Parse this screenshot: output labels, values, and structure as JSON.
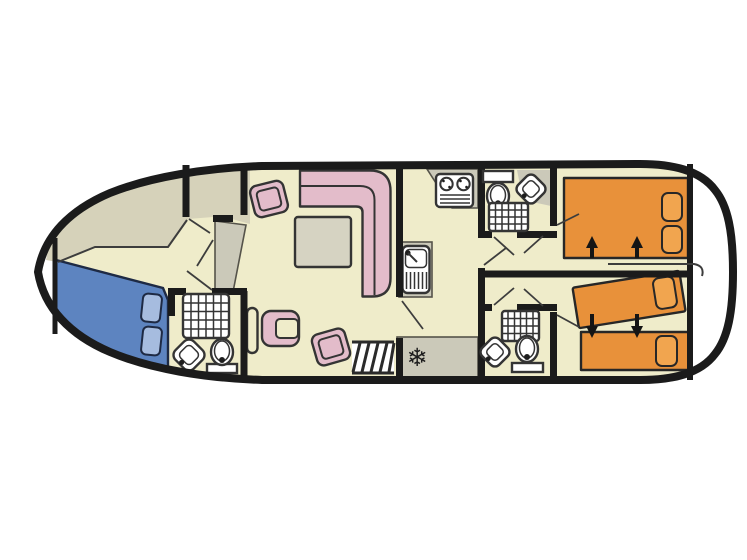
{
  "figure": {
    "kind": "boat-floorplan",
    "orientation": "bow-left",
    "visible_text": "none"
  },
  "colors": {
    "page_bg": "#ffffff",
    "wall": "#1b1b1b",
    "outline": "#343434",
    "floor": "#efecca",
    "deck": "#d6d2ba",
    "counter": "#cbc9b9",
    "table": "#d6d3c2",
    "pink": "#e3bcca",
    "blue_bed": "#5d84c0",
    "blue_pillow": "#a6bcdf",
    "orange": "#e8913a",
    "orange_pillow": "#f1a54f"
  },
  "icons": {
    "snowflake": "❄"
  },
  "rooms": [
    {
      "id": "bow-deck",
      "name": "bow deck walkway",
      "furniture": []
    },
    {
      "id": "bow-cabin",
      "name": "bow cabin",
      "furniture": [
        "blue double bed",
        "two pillows",
        "wardrobe"
      ]
    },
    {
      "id": "bow-bathroom",
      "name": "forward bathroom",
      "furniture": [
        "shower",
        "corner washbasin",
        "toilet"
      ]
    },
    {
      "id": "saloon",
      "name": "saloon and helm",
      "furniture": [
        "L-shaped sofa",
        "table",
        "chair",
        "chair",
        "helm seat",
        "steering wheel",
        "stairs"
      ]
    },
    {
      "id": "galley",
      "name": "galley",
      "furniture": [
        "two-burner hob",
        "sink",
        "worktop",
        "fridge-freezer"
      ]
    },
    {
      "id": "mid-bathroom-top",
      "name": "middle bathroom top",
      "furniture": [
        "toilet with cistern",
        "corner washbasin",
        "shower"
      ]
    },
    {
      "id": "corridor",
      "name": "central corridor",
      "furniture": []
    },
    {
      "id": "mid-bathroom-bottom",
      "name": "middle bathroom bottom",
      "furniture": [
        "shower",
        "corner washbasin",
        "toilet"
      ]
    },
    {
      "id": "aft-cabin-top",
      "name": "aft cabin top",
      "furniture": [
        "orange double bed",
        "two pillows"
      ],
      "arrows": "two up arrows"
    },
    {
      "id": "aft-cabin-bottom",
      "name": "aft cabin bottom",
      "furniture": [
        "angled orange single bed",
        "orange single bed",
        "two pillows"
      ],
      "arrows": "two down arrows"
    },
    {
      "id": "stern-deck",
      "name": "stern deck",
      "furniture": []
    }
  ]
}
